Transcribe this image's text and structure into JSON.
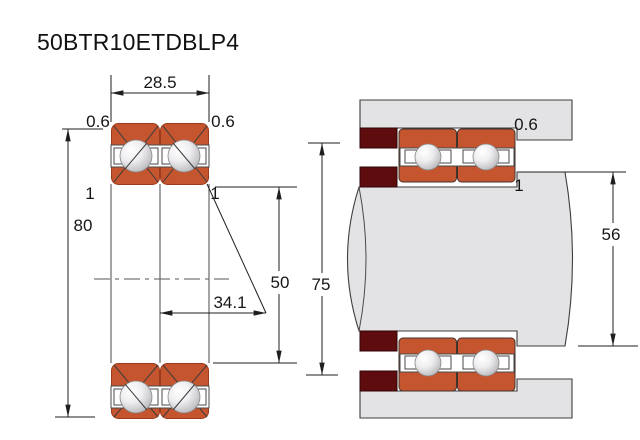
{
  "title": "50BTR10ETDBLP4",
  "left_view": {
    "name": "bearing pair cross-section",
    "dims": {
      "pair_width": "28.5",
      "chamfer_outer_left": "0.6",
      "chamfer_outer_right": "0.6",
      "chamfer_inner_left": "1",
      "chamfer_inner_right": "1",
      "outer_diameter": "80",
      "bore_diameter": "50",
      "effective_load_center": "34.1"
    }
  },
  "right_view": {
    "name": "mounting arrangement with shaft and housing",
    "dims": {
      "housing_fillet": "0.6",
      "shaft_fillet": "1",
      "housing_shoulder_diameter": "75",
      "shaft_shoulder_diameter": "56"
    }
  },
  "colors": {
    "ring": "#C5552E",
    "spacer": "#5E0C0E",
    "steel": "#E3E3E5",
    "line": "#1F1F1F"
  }
}
